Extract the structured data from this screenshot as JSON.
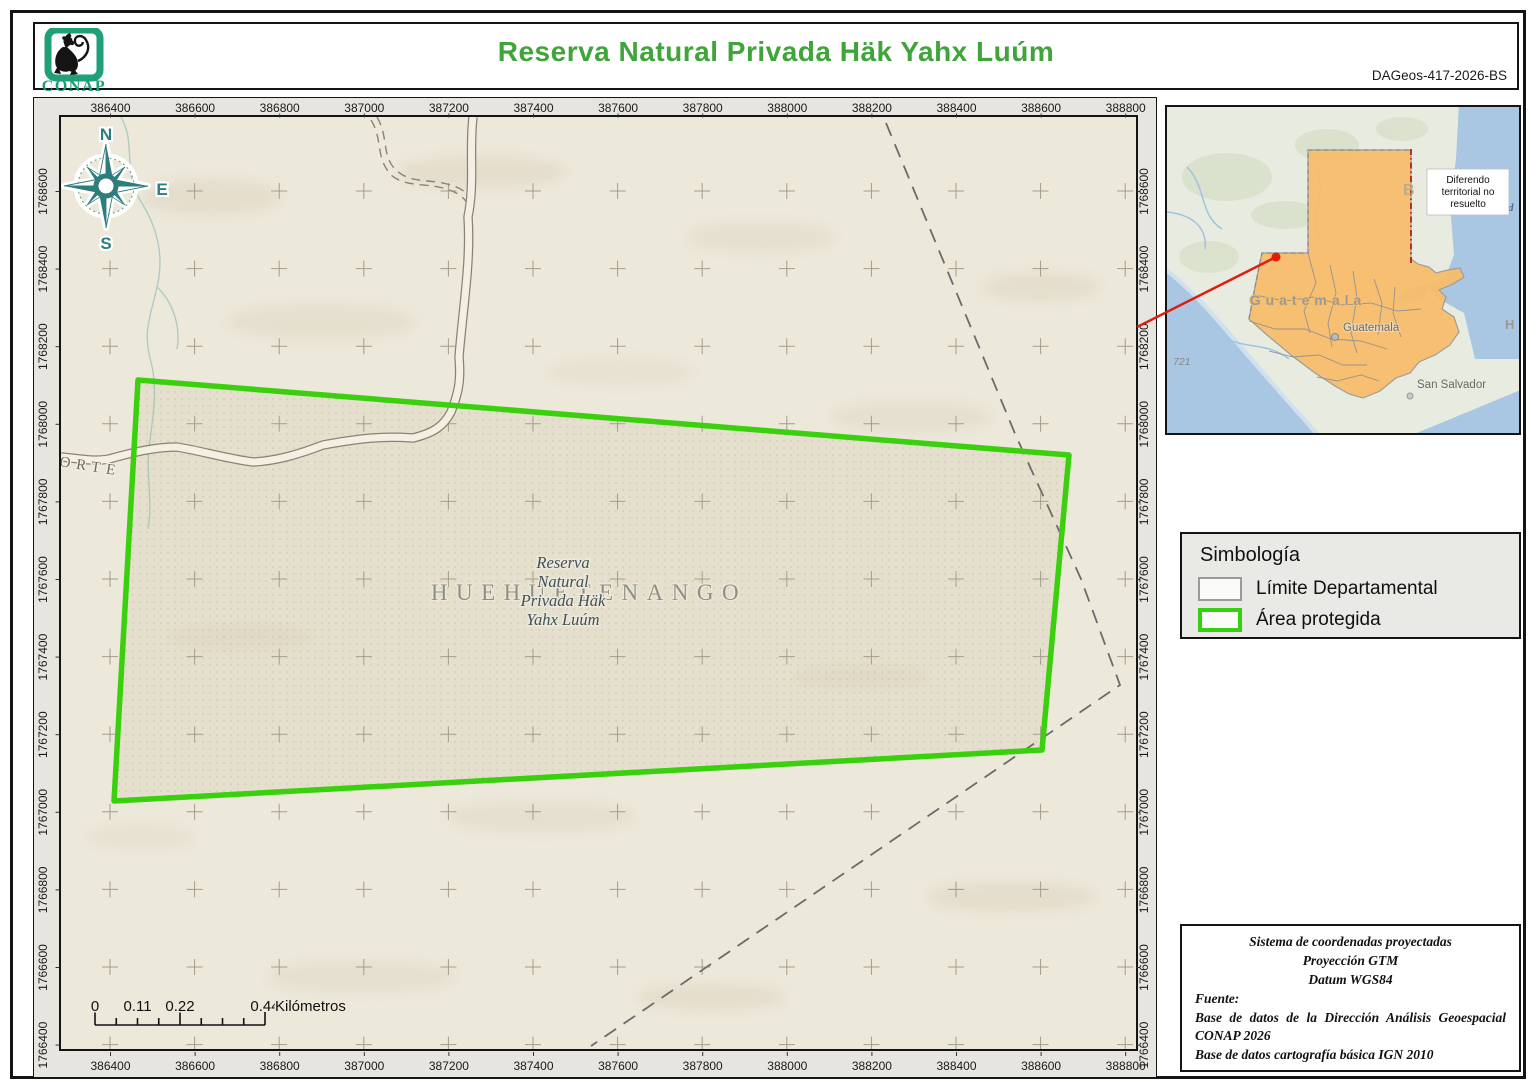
{
  "header": {
    "logo_text": "CONAP",
    "title": "Reserva Natural Privada Häk Yahx Luúm",
    "doc_id": "DAGeos-417-2026-BS"
  },
  "map": {
    "x_ticks": [
      "386400",
      "386600",
      "386800",
      "387000",
      "387200",
      "387400",
      "387600",
      "387800",
      "388000",
      "388200",
      "388400",
      "388600",
      "388800"
    ],
    "y_ticks": [
      "1768600",
      "1768400",
      "1768200",
      "1768000",
      "1767800",
      "1767600",
      "1767400",
      "1767200",
      "1767000",
      "1766800",
      "1766600",
      "1766400"
    ],
    "compass": {
      "n": "N",
      "e": "E",
      "s": "S",
      "o": "O"
    },
    "labels": {
      "department": "HUEHUETENANGO",
      "reserve_lines": [
        "Reserva",
        "Natural",
        "Privada Häk",
        "Yahx Luúm"
      ],
      "road": "ORTE"
    },
    "scale_bar": {
      "labels": [
        "0",
        "0.11",
        "0.22",
        "0.44"
      ],
      "unit": "Kilómetros"
    }
  },
  "inset": {
    "country_label": "Guatemala",
    "city_label": "Guatemala",
    "san_salvador_label": "San Salvador",
    "annotation_lines": [
      "Diferendo",
      "territorial no",
      "resuelto"
    ],
    "num_label": "721",
    "hond_label": "Hond",
    "ho_label": "Ho",
    "b_label": "B"
  },
  "legend": {
    "title": "Simbología",
    "items": [
      {
        "label": "Límite Departamental",
        "color": "#9b9b9b"
      },
      {
        "label": "Área protegida",
        "color": "#35d010"
      }
    ]
  },
  "credits": {
    "center_lines": [
      "Sistema de coordenadas proyectadas",
      "Proyección GTM",
      "Datum WGS84"
    ],
    "fuente_label": "Fuente:",
    "source_1": "Base de datos de la Dirección Análisis Geoespacial CONAP 2026",
    "source_2": "Base de datos cartografía básica IGN 2010"
  },
  "colors": {
    "title_green": "#3fa439",
    "protected_area_green": "#3ad00e",
    "compass_teal": "#2e7d7c",
    "country_orange": "#f7bd6c",
    "locator_red": "#e11c0e",
    "logo_green": "#1fa078"
  }
}
